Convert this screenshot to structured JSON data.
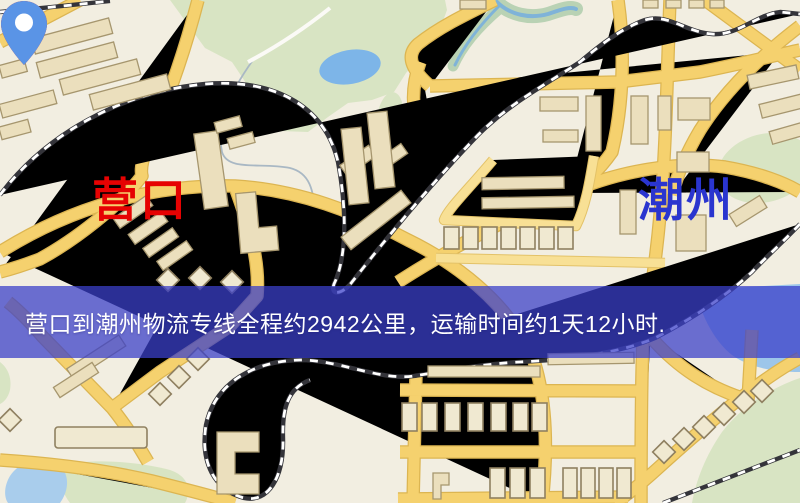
{
  "map": {
    "kind": "logistics-route-map",
    "origin": {
      "name": "营口",
      "label_color": "#e60202",
      "pin_color": "#ee1506"
    },
    "destination": {
      "name": "潮州",
      "label_color": "#2a35cf",
      "pin_color": "#5a94e6"
    },
    "banner": {
      "text": "营口到潮州物流专线全程约2942公里，运输时间约1天12小时.",
      "background": "#3a3fc9",
      "text_color": "#ffffff"
    },
    "route": {
      "distance": "2942公里",
      "duration": "1天12小时"
    }
  }
}
